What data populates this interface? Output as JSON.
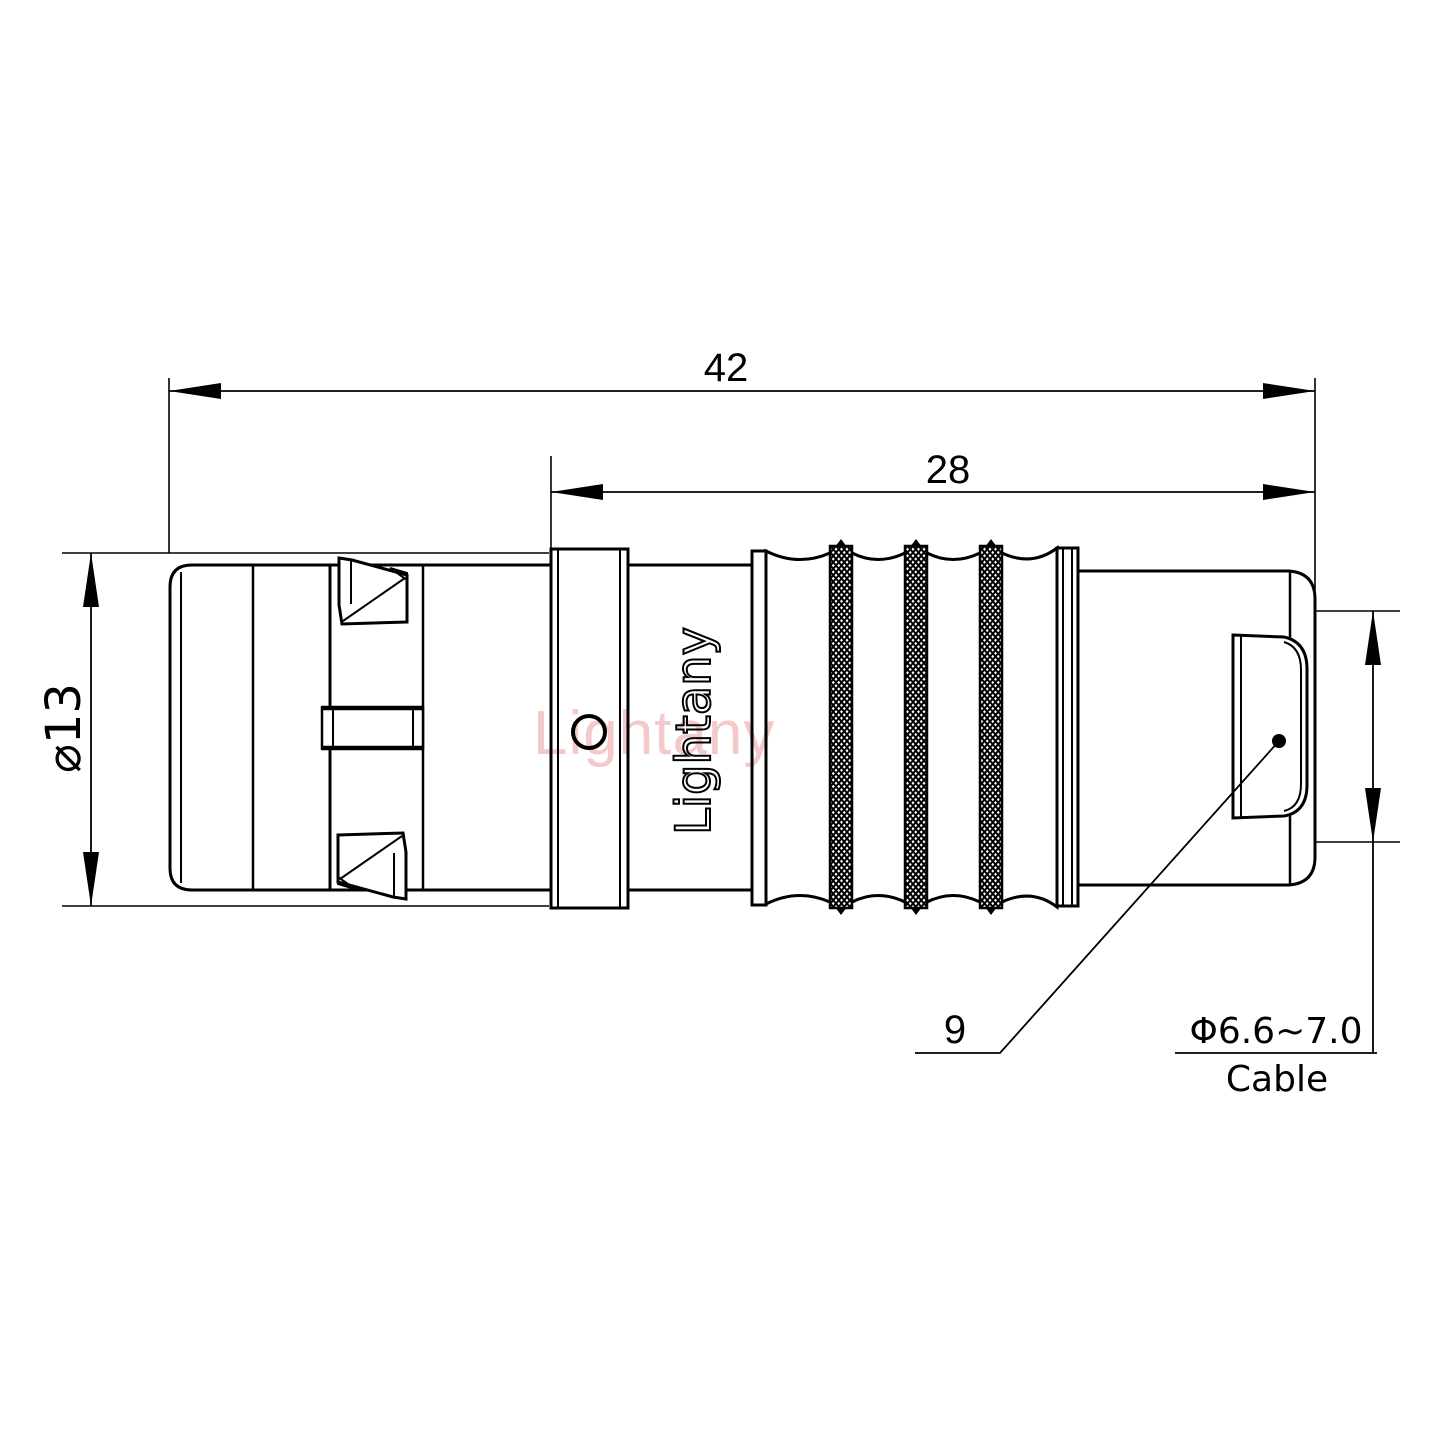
{
  "drawing": {
    "type": "connector-technical-drawing",
    "dimensions": {
      "overall_length": "42",
      "rear_section_length": "28",
      "body_diameter": "⌀13",
      "item_reference": "9",
      "cable_diameter": "Φ6.6~7.0",
      "cable_label": "Cable"
    },
    "branding": {
      "watermark_text": "Lightany",
      "engraved_text": "Lightany"
    },
    "colors": {
      "line": "#000000",
      "background": "#ffffff",
      "watermark": "#f2c3c3"
    }
  }
}
